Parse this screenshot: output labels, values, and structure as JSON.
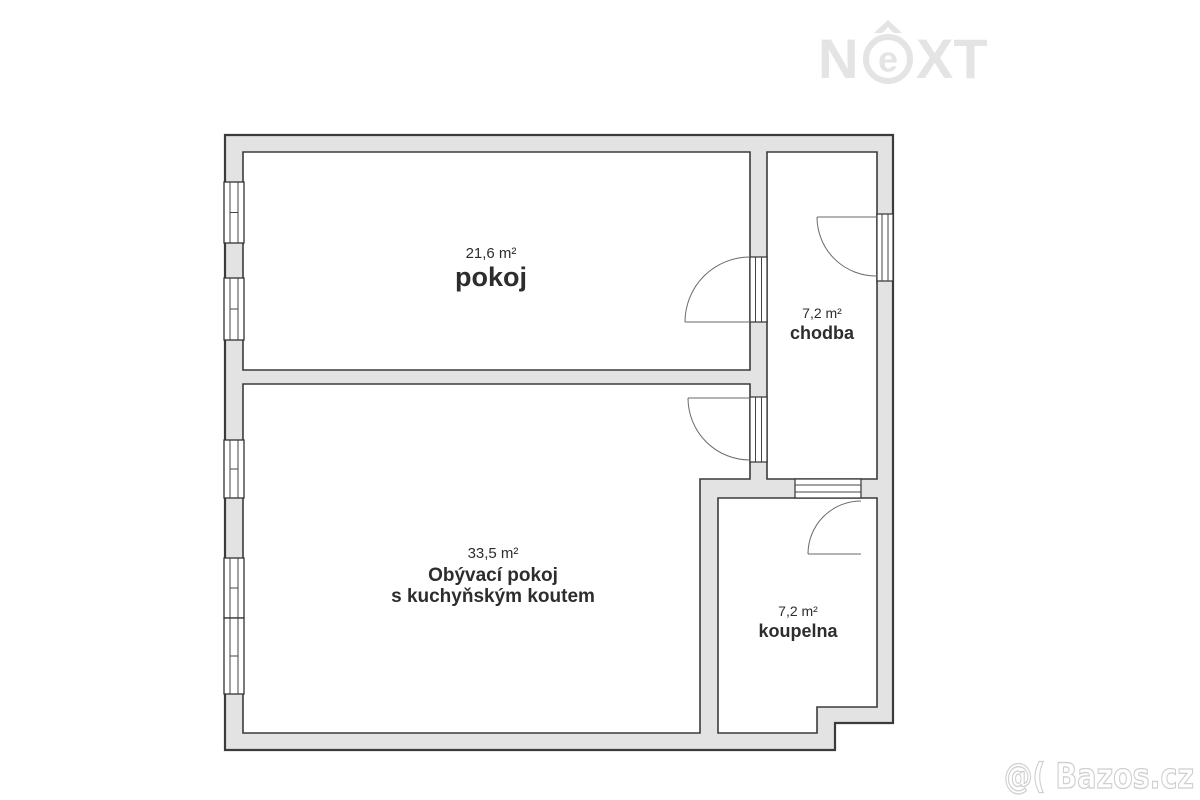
{
  "brand": {
    "name": "NEXT",
    "n": "N",
    "e": "e",
    "xt": "XT"
  },
  "watermark": {
    "credit": "@( Bazos.cz"
  },
  "rooms": {
    "pokoj": {
      "area": "21,6 m²",
      "name": "pokoj"
    },
    "chodba": {
      "area": "7,2 m²",
      "name": "chodba"
    },
    "obyvaci": {
      "area": "33,5 m²",
      "name": "Obývací pokoj",
      "name2": "s kuchyňským koutem"
    },
    "koupelna": {
      "area": "7,2 m²",
      "name": "koupelna"
    }
  },
  "colors": {
    "wall_fill": "#e3e3e3",
    "wall_outline": "#3b3b3b",
    "label_text": "#2d2d2d",
    "watermark_gray": "#e4e4e4"
  }
}
